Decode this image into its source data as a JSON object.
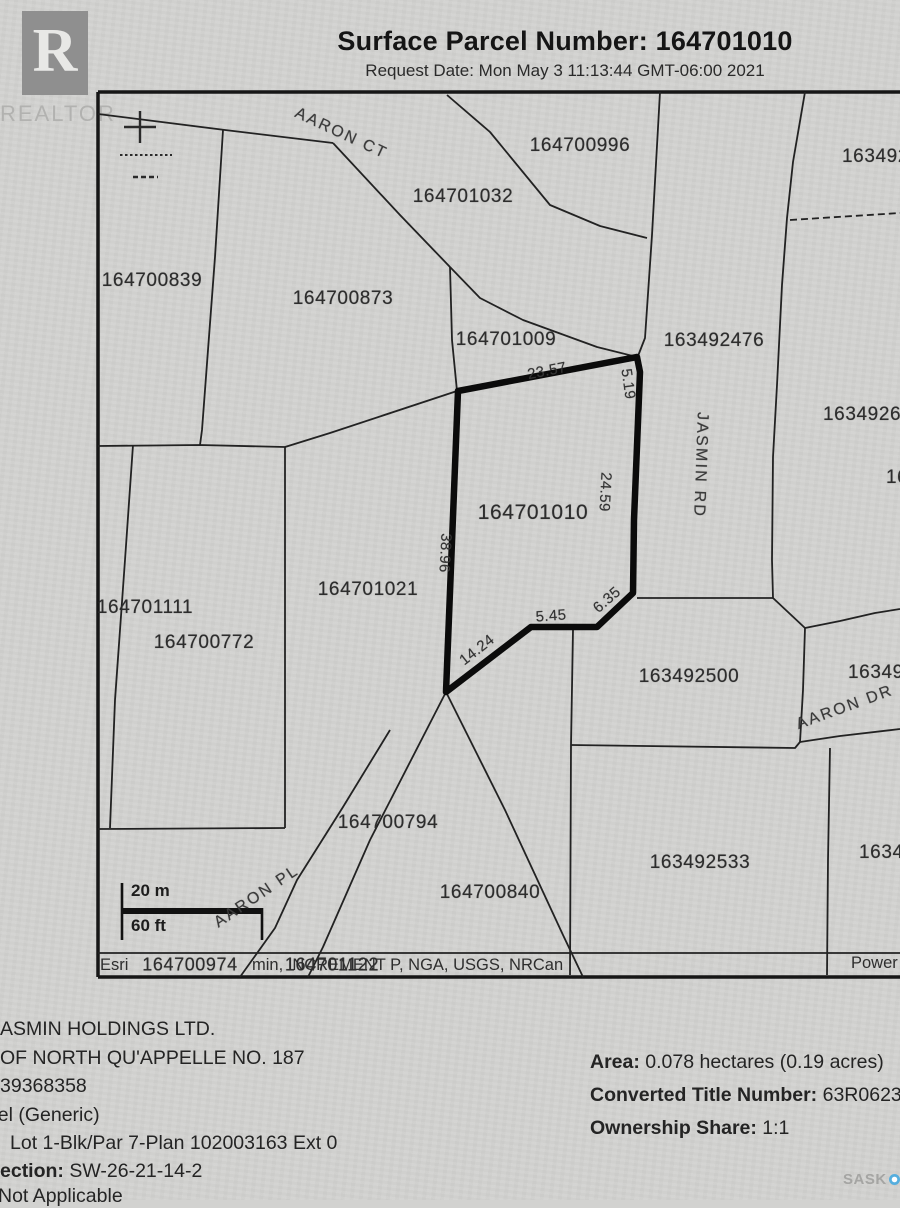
{
  "header": {
    "title": "Surface Parcel Number: 164701010",
    "request_date": "Request Date: Mon May 3 11:13:44 GMT-06:00 2021"
  },
  "logos": {
    "realtor_letter": "R",
    "realtor_text": "REALTOR",
    "saskmls_left": "SASK",
    "saskmls_right": "MLS",
    "saskmls_reg": "®"
  },
  "colors": {
    "paper": "#d2d2d0",
    "line": "#1f1f1f",
    "highlight_parcel": "#0b0b0b",
    "saskmls_dot": "#55aede"
  },
  "map": {
    "parcels": [
      {
        "label": "164700996",
        "x": 580,
        "y": 146
      },
      {
        "label": "164701032",
        "x": 463,
        "y": 197
      },
      {
        "label": "163492",
        "x": 842,
        "y": 157,
        "anchor": "start"
      },
      {
        "label": "164700839",
        "x": 152,
        "y": 281
      },
      {
        "label": "164700873",
        "x": 343,
        "y": 299
      },
      {
        "label": "164701009",
        "x": 506,
        "y": 340
      },
      {
        "label": "163492476",
        "x": 714,
        "y": 341
      },
      {
        "label": "1634926",
        "x": 823,
        "y": 415,
        "anchor": "start"
      },
      {
        "label": "164701010",
        "x": 533,
        "y": 513,
        "size": 21
      },
      {
        "label": "164701021",
        "x": 368,
        "y": 590
      },
      {
        "label": "164701111",
        "x": 145,
        "y": 608
      },
      {
        "label": "164700772",
        "x": 204,
        "y": 643
      },
      {
        "label": "16",
        "x": 886,
        "y": 478,
        "anchor": "start"
      },
      {
        "label": "163492500",
        "x": 689,
        "y": 677
      },
      {
        "label": "163492",
        "x": 848,
        "y": 673,
        "anchor": "start"
      },
      {
        "label": "164700794",
        "x": 388,
        "y": 823
      },
      {
        "label": "164700840",
        "x": 490,
        "y": 893
      },
      {
        "label": "163492533",
        "x": 700,
        "y": 863
      },
      {
        "label": "1634",
        "x": 859,
        "y": 853,
        "anchor": "start"
      },
      {
        "label": "164700974",
        "x": 190,
        "y": 965,
        "size": 18
      },
      {
        "label": "164701122",
        "x": 332,
        "y": 965,
        "size": 18
      }
    ],
    "streets": [
      {
        "name": "AARON CT",
        "x": 341,
        "y": 134,
        "rot": 25
      },
      {
        "name": "JASMIN RD",
        "x": 700,
        "y": 465,
        "rot": 92
      },
      {
        "name": "AARON DR",
        "x": 845,
        "y": 708,
        "rot": -20
      },
      {
        "name": "AARON PL",
        "x": 257,
        "y": 897,
        "rot": -34
      }
    ],
    "dimensions": [
      {
        "value": "23.57",
        "x": 547,
        "y": 371,
        "rot": -11
      },
      {
        "value": "5.19",
        "x": 628,
        "y": 384,
        "rot": 82
      },
      {
        "value": "24.59",
        "x": 605,
        "y": 492,
        "rot": 93
      },
      {
        "value": "38.96",
        "x": 445,
        "y": 553,
        "rot": 93
      },
      {
        "value": "14.24",
        "x": 477,
        "y": 650,
        "rot": -38
      },
      {
        "value": "5.45",
        "x": 551,
        "y": 616,
        "rot": -4
      },
      {
        "value": "6.35",
        "x": 607,
        "y": 600,
        "rot": -41
      }
    ],
    "scale_bar": {
      "metric": "20 m",
      "imperial": "60 ft"
    },
    "attribution": {
      "part1": "Esri",
      "part2": "min, INCREMENT P, NGA, USGS, NRCan",
      "powered": "Power"
    }
  },
  "details_left": {
    "lines": [
      {
        "text": "ASMIN HOLDINGS LTD.",
        "x": 0,
        "y": 1030
      },
      {
        "text": "OF NORTH QU'APPELLE NO. 187",
        "x": 0,
        "y": 1059
      },
      {
        "text": "39368358",
        "x": 0,
        "y": 1087
      },
      {
        "text": "cel (Generic)",
        "x": -12,
        "y": 1116
      },
      {
        "text": "Lot 1-Blk/Par 7-Plan 102003163 Ext 0",
        "x": 10,
        "y": 1144
      },
      {
        "bold": "ection:",
        "text": " SW-26-21-14-2",
        "x": 0,
        "y": 1172
      },
      {
        "text": "Not Applicable",
        "x": -2,
        "y": 1197
      }
    ]
  },
  "details_right": {
    "x": 590,
    "lines": [
      {
        "bold": "Area:",
        "text": " 0.078 hectares (0.19 acres)",
        "y": 1063
      },
      {
        "bold": "Converted Title Number:",
        "text": " 63R06239",
        "y": 1096
      },
      {
        "bold": "Ownership Share:",
        "text": " 1:1",
        "y": 1129
      }
    ]
  }
}
